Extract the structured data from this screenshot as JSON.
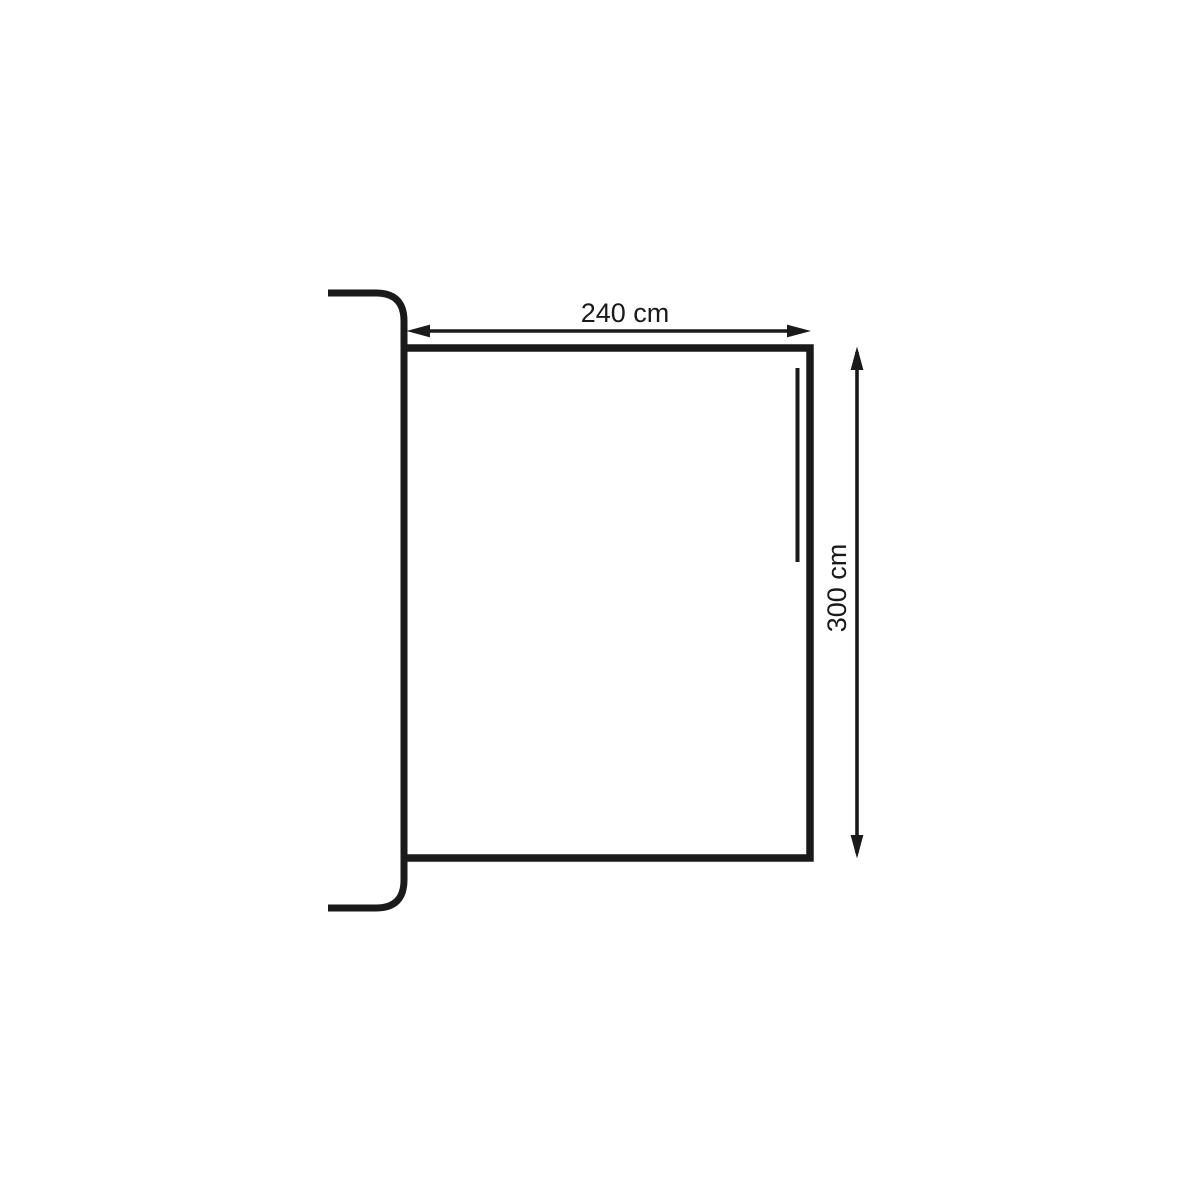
{
  "diagram": {
    "type": "dimension-drawing",
    "subject": "panel-with-rail-profile",
    "background": "#ffffff",
    "line_color": "#1a1a1a",
    "width_dimension": {
      "label": "240 cm",
      "value": 240,
      "unit": "cm",
      "orientation": "horizontal"
    },
    "height_dimension": {
      "label": "300 cm",
      "value": 300,
      "unit": "cm",
      "orientation": "vertical"
    }
  }
}
